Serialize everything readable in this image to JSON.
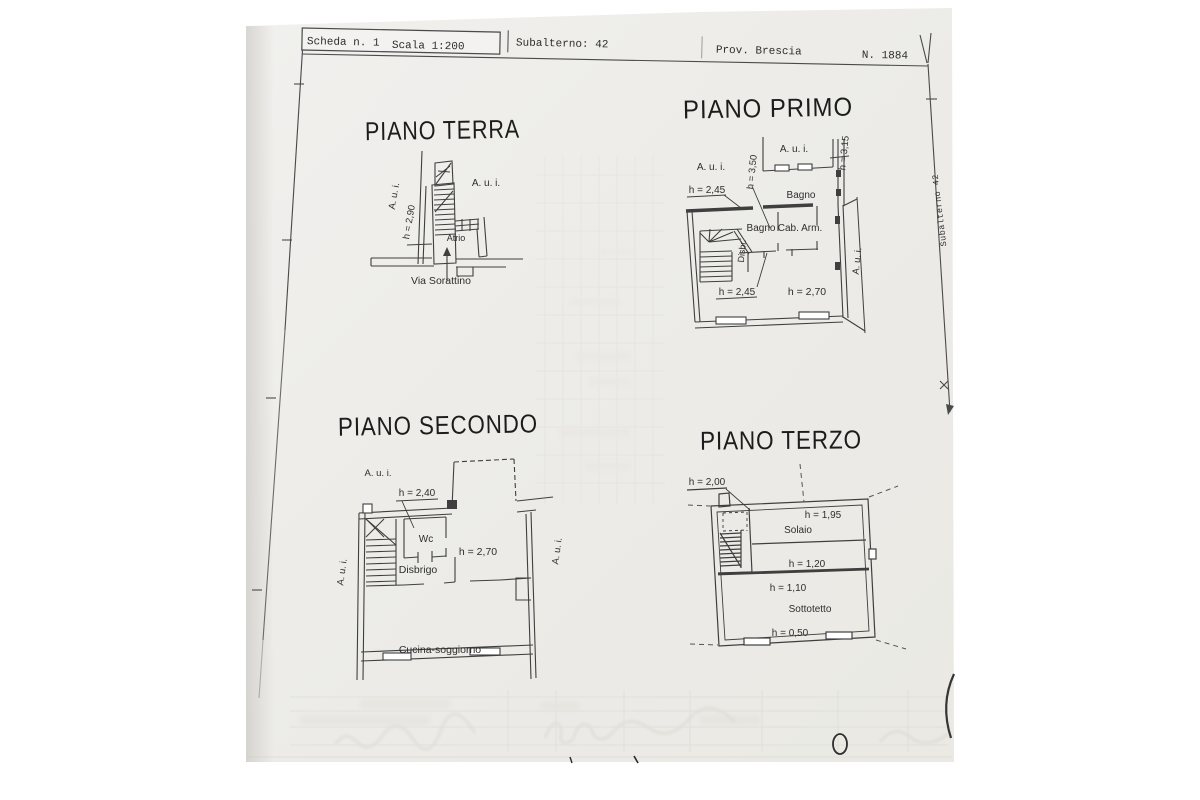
{
  "header": {
    "scheda": "Scheda n. 1",
    "scala": "Scala 1:200",
    "subalterno": "Subalterno: 42",
    "provincia": "Prov. Brescia",
    "numero": "N. 1884"
  },
  "edge_note": "Subalterno 42",
  "colors": {
    "ink": "#3f3f3f",
    "paper": "#edece8",
    "title_ink": "#1c1c1c"
  },
  "plans": {
    "terra": {
      "title": "PIANO TERRA",
      "labels": {
        "aui_left": "A. u. i.",
        "aui_right": "A. u. i.",
        "height": "h = 2,90",
        "atrio": "Atrio",
        "street": "Via Sorattino"
      }
    },
    "primo": {
      "title": "PIANO PRIMO",
      "labels": {
        "aui_left": "A. u. i.",
        "aui_top": "A. u. i.",
        "aui_right": "A. u. i.",
        "h350": "h = 3,50",
        "h315": "h = 3,15",
        "h245_top": "h = 2,45",
        "bagno_top": "Bagno",
        "bagno_mid": "Bagno",
        "cab_arm": "Cab. Arm.",
        "disbr": "Disbr.",
        "h245_bottom": "h = 2,45",
        "h270": "h = 2,70"
      }
    },
    "secondo": {
      "title": "PIANO SECONDO",
      "labels": {
        "aui_top": "A. u. i.",
        "aui_left": "A. u. i.",
        "aui_right": "A. u. i.",
        "h240": "h = 2,40",
        "wc": "Wc",
        "h270": "h = 2,70",
        "disbrigo": "Disbrigo",
        "cucina": "Cucina-soggiorno"
      }
    },
    "terzo": {
      "title": "PIANO TERZO",
      "labels": {
        "h200": "h = 2,00",
        "h195": "h = 1,95",
        "solaio": "Solaio",
        "h120": "h = 1,20",
        "h110": "h = 1,10",
        "sottotetto": "Sottotetto",
        "h050": "h = 0,50"
      }
    }
  }
}
